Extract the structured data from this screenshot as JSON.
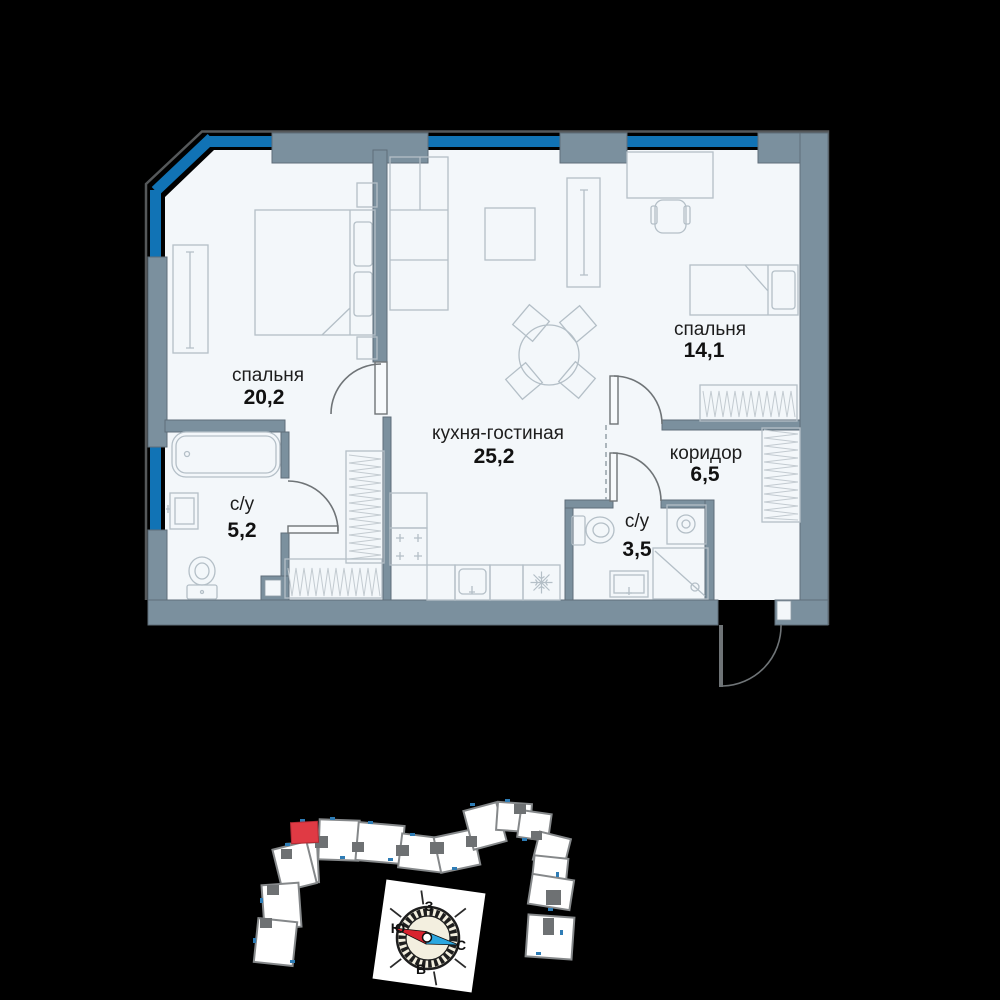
{
  "plan": {
    "rooms": [
      {
        "id": "bedroom-1",
        "name": "спальня",
        "area": "20,2"
      },
      {
        "id": "kitchen-living",
        "name": "кухня-гостиная",
        "area": "25,2"
      },
      {
        "id": "bedroom-2",
        "name": "спальня",
        "area": "14,1"
      },
      {
        "id": "corridor",
        "name": "коридор",
        "area": "6,5"
      },
      {
        "id": "bathroom-1",
        "name": "с/у",
        "area": "5,2"
      },
      {
        "id": "bathroom-2",
        "name": "с/у",
        "area": "3,5"
      }
    ]
  },
  "compass": {
    "top": "З",
    "left": "Ю",
    "right": "С",
    "bottom": "В"
  },
  "colors": {
    "wall": "#7b909e",
    "window": "#1173b5",
    "room_fill": "#f3f7fa",
    "highlight_unit": "#e03a44",
    "needle_red": "#d8232f",
    "needle_blue": "#2ba7e0"
  }
}
